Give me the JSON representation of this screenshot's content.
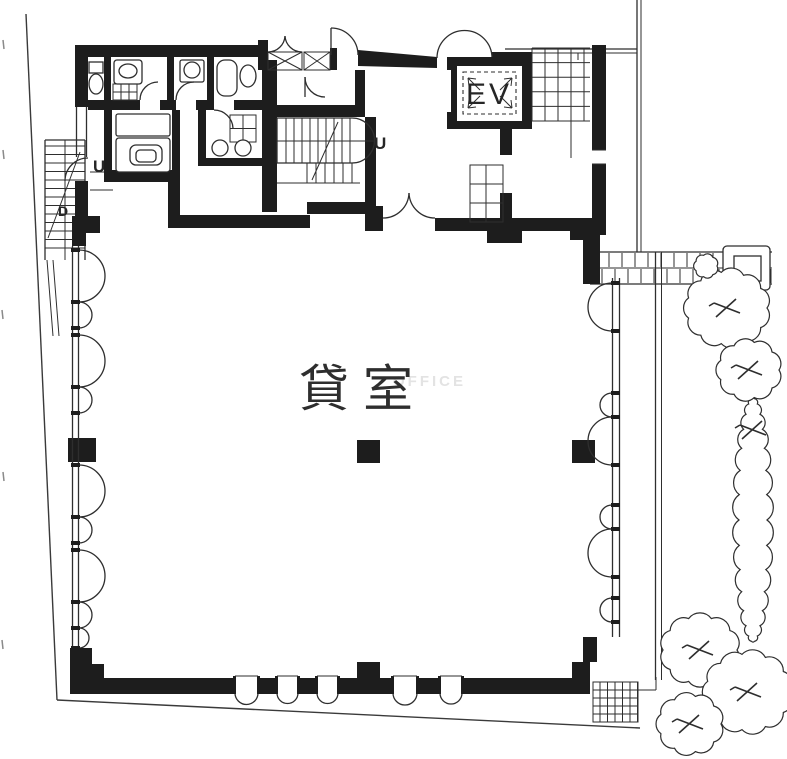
{
  "labels": {
    "rental_room": "貸室",
    "elevator": "EV",
    "stair_up_interior": "U",
    "stair_up_exterior": "U",
    "stair_down_exterior": "D",
    "watermark": "OFFICE"
  },
  "colors": {
    "wall": "#1d1d1d",
    "line": "#2e2e2e",
    "watermark": "#e3e3e3",
    "background": "#ffffff"
  }
}
